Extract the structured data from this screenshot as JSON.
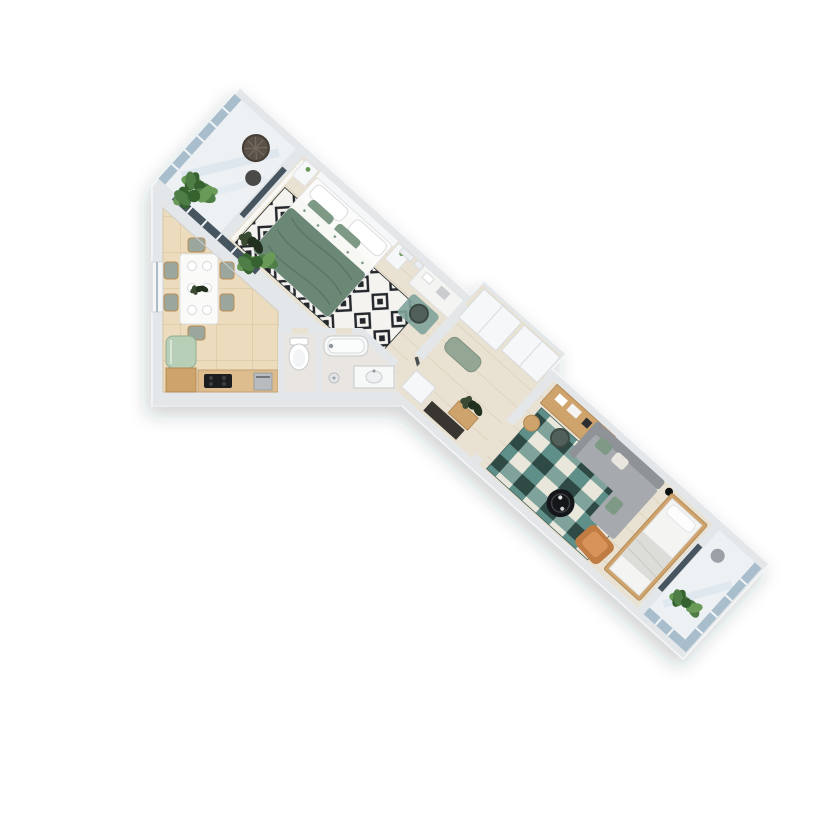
{
  "scene": {
    "kind": "3d-floorplan-top-view-render",
    "description": "Photorealistic top-down 3D render of a one-bedroom apartment floating on a white background. An axis-aligned dining/kitchen block sits at the lower left; a long wing rotated about 42 degrees runs from a glazed balcony at the top-left tip through a bedroom, hallway and living/sleeping area to a second glazed balcony at the lower right.",
    "background": "#ffffff"
  },
  "palette": {
    "wall": "#e4e7ea",
    "wall_line": "#cdd2d6",
    "wood": "#e9e1d1",
    "plank": "#dcd2bf",
    "tile": "#ecdcbd",
    "tile_line": "#ddc9a5",
    "balcony": "#eef1f4",
    "glass": "#a9becd",
    "glass_dark": "#46555f",
    "white_furn": "#f6f7f8",
    "bed_green": "#6b8877",
    "bed_green_line": "#5b7767",
    "pillow_green": "#7e9a87",
    "sofa": "#a6aaae",
    "sofa_dark": "#8f9296",
    "armchair": "#c07c42",
    "armchair_light": "#d8935a",
    "wood_furn": "#cfa36c",
    "counter": "#ddbc8d",
    "fridge": "#b7cfb6",
    "bench": "#94a694",
    "mat_teal": "#7fa39b",
    "rug_base": "#f4f3f0",
    "rug_ink": "#23262a",
    "teal_a": "#5e8f89",
    "teal_b": "#e9e7dc",
    "teal_c": "#2f4a45",
    "teal_d": "#7fa39b",
    "plant_a": "#4e7d46",
    "plant_b": "#6a9a58",
    "plant_c": "#35622f",
    "plant_dark_a": "#22301f",
    "plant_dark_b": "#3a4a33",
    "black": "#141619",
    "cooktop": "#1c1d1f",
    "steel": "#b9bcbe"
  },
  "rooms": [
    {
      "id": "balcony-top",
      "name": "Loggia (top)",
      "furniture": [
        "round bistro table",
        "chair",
        "potted plant",
        "glazed facade"
      ]
    },
    {
      "id": "bedroom",
      "name": "Bedroom",
      "furniture": [
        "double bed with green duvet",
        "two nightstands",
        "black-and-white diamond rug",
        "desk with chair",
        "teal mat",
        "dark plant",
        "wall frames"
      ]
    },
    {
      "id": "dining-kitchen",
      "name": "Kitchen / dining room",
      "furniture": [
        "white dining table with six chairs and plates",
        "mint fridge",
        "kitchen counter with cooktop",
        "oven",
        "large plant",
        "window"
      ]
    },
    {
      "id": "wc",
      "name": "WC",
      "furniture": [
        "toilet"
      ]
    },
    {
      "id": "bathroom",
      "name": "Bathroom",
      "furniture": [
        "bathtub",
        "vanity with basin",
        "floor lamp"
      ]
    },
    {
      "id": "hallway",
      "name": "Hallway",
      "furniture": [
        "built-in wardrobes",
        "green bench",
        "white dresser",
        "console with dark plant",
        "entry door"
      ]
    },
    {
      "id": "living-room",
      "name": "Living / sleeping room",
      "furniture": [
        "desk with chair",
        "gray corner sofa with green pillows",
        "teal checkered rug",
        "round black coffee table",
        "orange armchair",
        "bed with white bedding",
        "floor lamps",
        "side table"
      ]
    },
    {
      "id": "balcony-bottom",
      "name": "Loggia (bottom)",
      "furniture": [
        "potted plant",
        "small table",
        "glazed facade"
      ]
    }
  ]
}
